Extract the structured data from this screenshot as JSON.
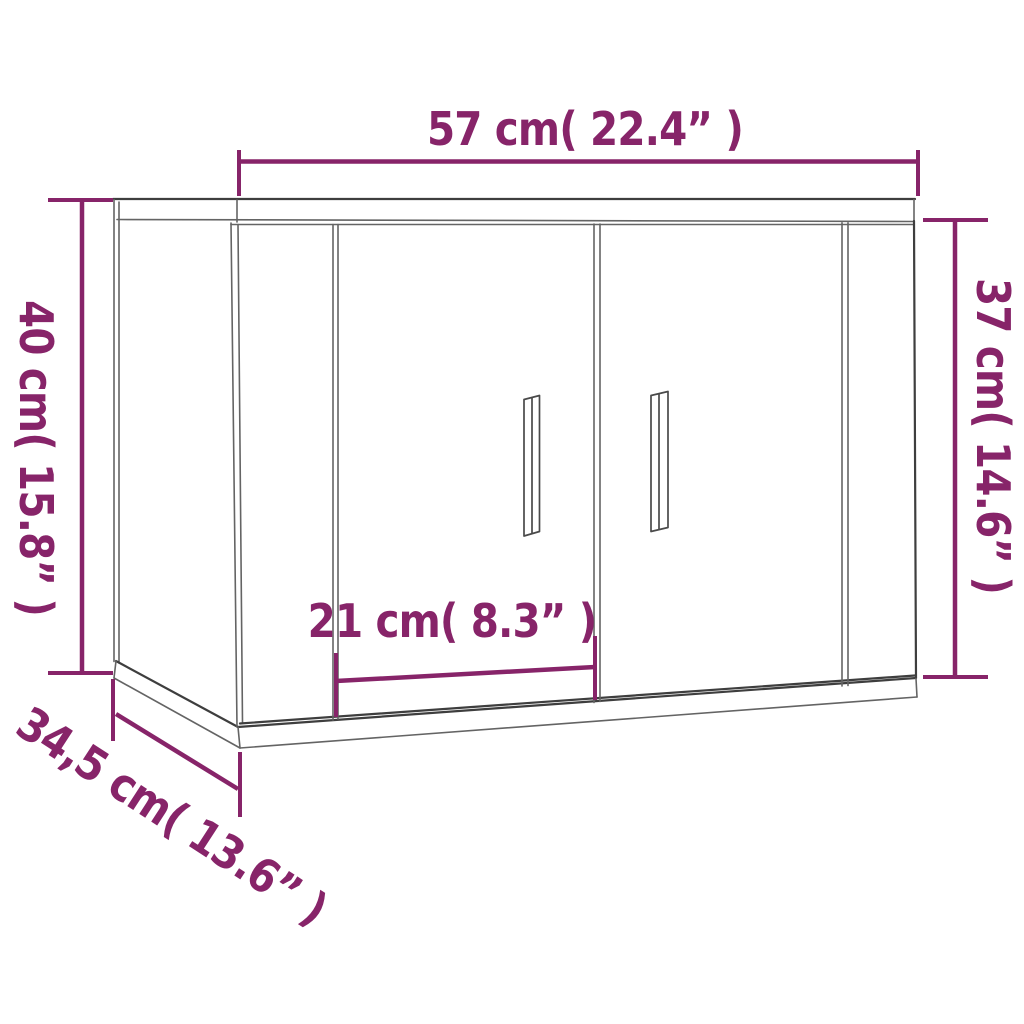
{
  "page": {
    "background_color": "#ffffff"
  },
  "diagram": {
    "kind": "furniture-dimension-line-drawing",
    "subject": "wall-mounted cabinet with two doors, shown in perspective",
    "colors": {
      "accent": "#872469",
      "line_dark": "#3e3e3e",
      "line_mid": "#646464"
    },
    "dimensions": {
      "width_top": "57 cm( 22.4” )",
      "height_left": "40 cm( 15.8” )",
      "height_right": "37 cm( 14.6” )",
      "inner_width": "21 cm( 8.3” )",
      "depth": "34,5 cm( 13.6” )"
    }
  }
}
